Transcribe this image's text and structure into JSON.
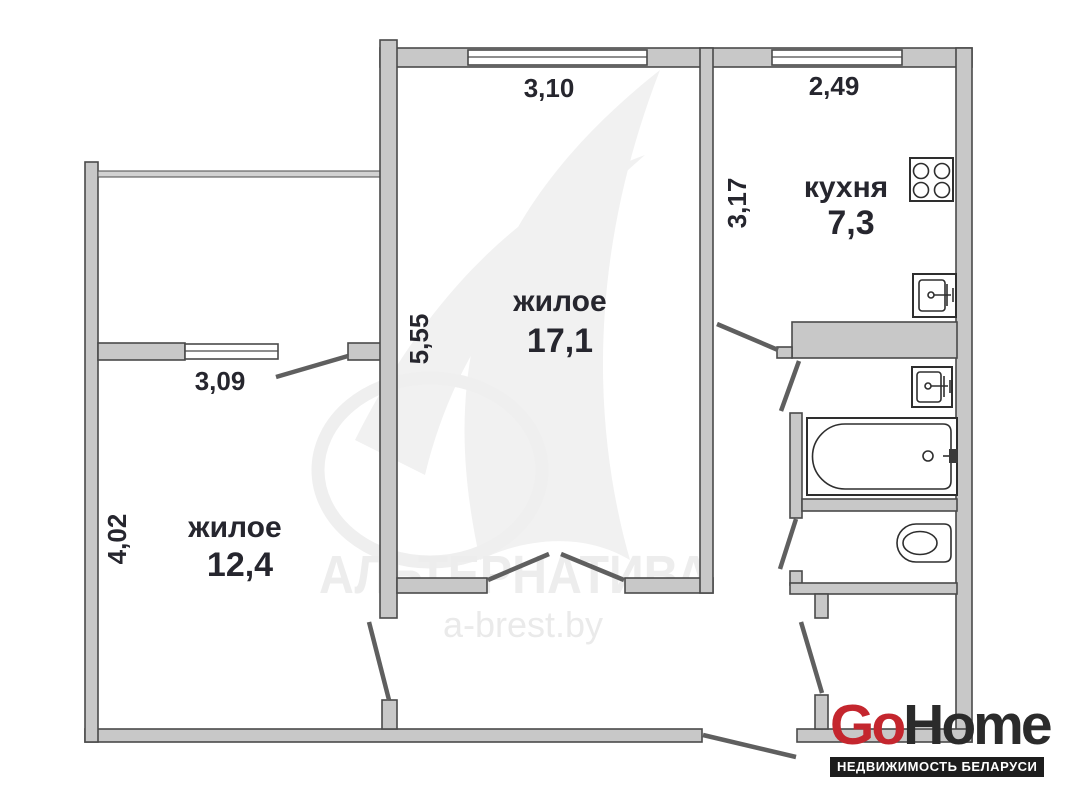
{
  "plan": {
    "rooms": [
      {
        "id": "living-main",
        "label": "жилое",
        "area": "17,1",
        "width_m": "3,10",
        "depth_m": "5,55"
      },
      {
        "id": "living-second",
        "label": "жилое",
        "area": "12,4",
        "width_m": "3,09",
        "depth_m": "4,02"
      },
      {
        "id": "kitchen",
        "label": "кухня",
        "area": "7,3",
        "width_m": "2,49",
        "depth_m": "3,17"
      }
    ],
    "fixtures": [
      {
        "id": "stove",
        "icon": "stove-icon"
      },
      {
        "id": "kitchen-sink",
        "icon": "sink-icon"
      },
      {
        "id": "bathroom-sink",
        "icon": "sink-icon"
      },
      {
        "id": "bathtub",
        "icon": "bathtub-icon"
      },
      {
        "id": "toilet",
        "icon": "toilet-icon"
      }
    ]
  },
  "watermark": {
    "brand": "АЛЬТЕРНАТИВА",
    "site": "a-brest.by"
  },
  "logo": {
    "go": "Go",
    "home": "Home",
    "tagline": "НЕДВИЖИМОСТЬ БЕЛАРУСИ"
  },
  "colors": {
    "wall": "#c8c8c8",
    "wall-outline": "#4a4a4a",
    "label": "#26262e",
    "leaf": "#5f5f5f",
    "logo-red": "#c4262e",
    "logo-dark": "#2b2b2b",
    "banner-bg": "#1d1d1d",
    "banner-text": "#ffffff",
    "watermark": "#ededed",
    "watermark-swoosh": "#f1f1f1"
  }
}
